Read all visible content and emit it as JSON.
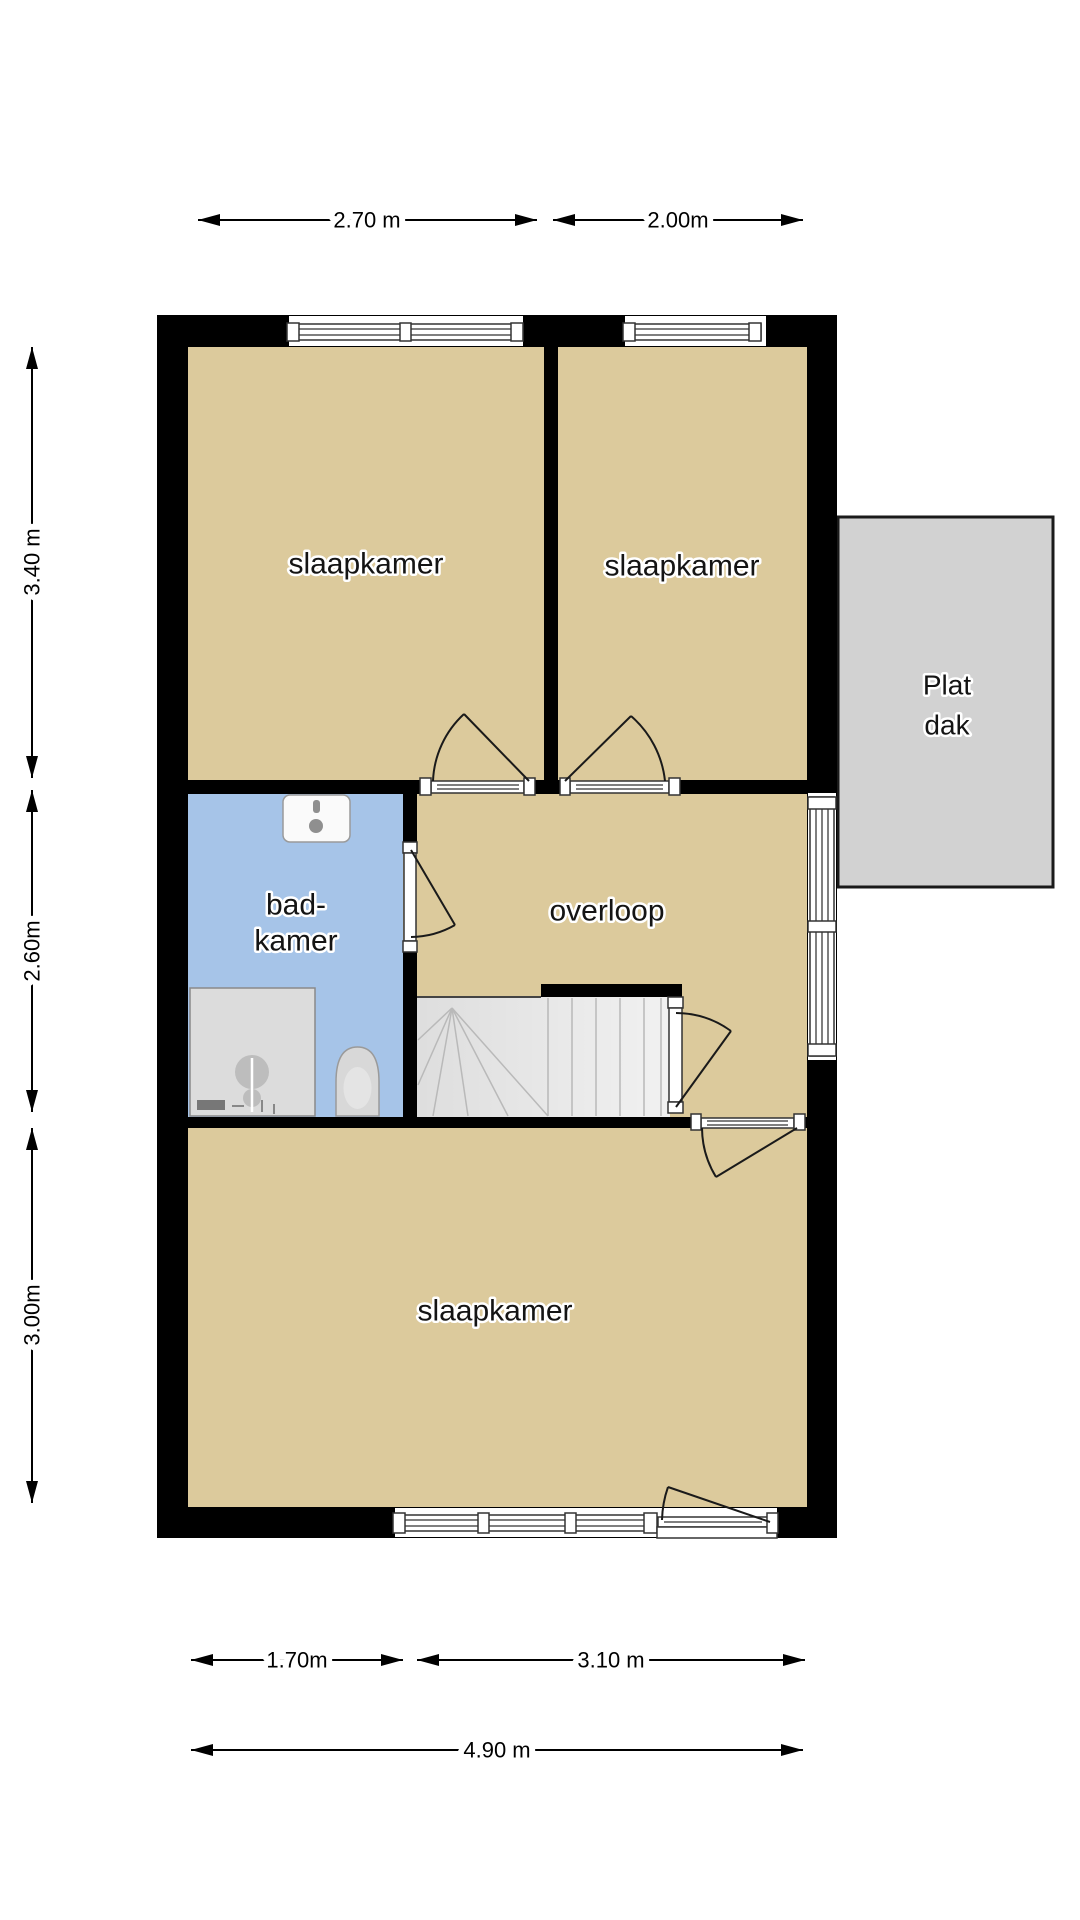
{
  "floor_plan": {
    "rooms": {
      "bedroom_top_left": {
        "label": "slaapkamer"
      },
      "bedroom_top_right": {
        "label": "slaapkamer"
      },
      "bedroom_bottom": {
        "label": "slaapkamer"
      },
      "bathroom": {
        "label_line1": "bad-",
        "label_line2": "kamer"
      },
      "landing": {
        "label": "overloop"
      },
      "flat_roof": {
        "label_line1": "Plat",
        "label_line2": "dak"
      }
    },
    "dimensions": {
      "top_width_left": "2.70 m",
      "top_width_right": "2.00m",
      "side_height_top": "3.40 m",
      "side_height_middle": "2.60m",
      "side_height_bottom": "3.00m",
      "bottom_width_left": "1.70m",
      "bottom_width_right": "3.10 m",
      "bottom_width_total": "4.90 m"
    },
    "colors": {
      "wall": "#000000",
      "room_fill": "#DCCA9C",
      "bathroom_fill": "#A6C4E8",
      "flat_roof_fill": "#D2D2D2",
      "flat_roof_border": "#1A1A1A",
      "stairs_fill": "#F1F1F1",
      "fixture_fill": "#D8D8D8"
    }
  }
}
